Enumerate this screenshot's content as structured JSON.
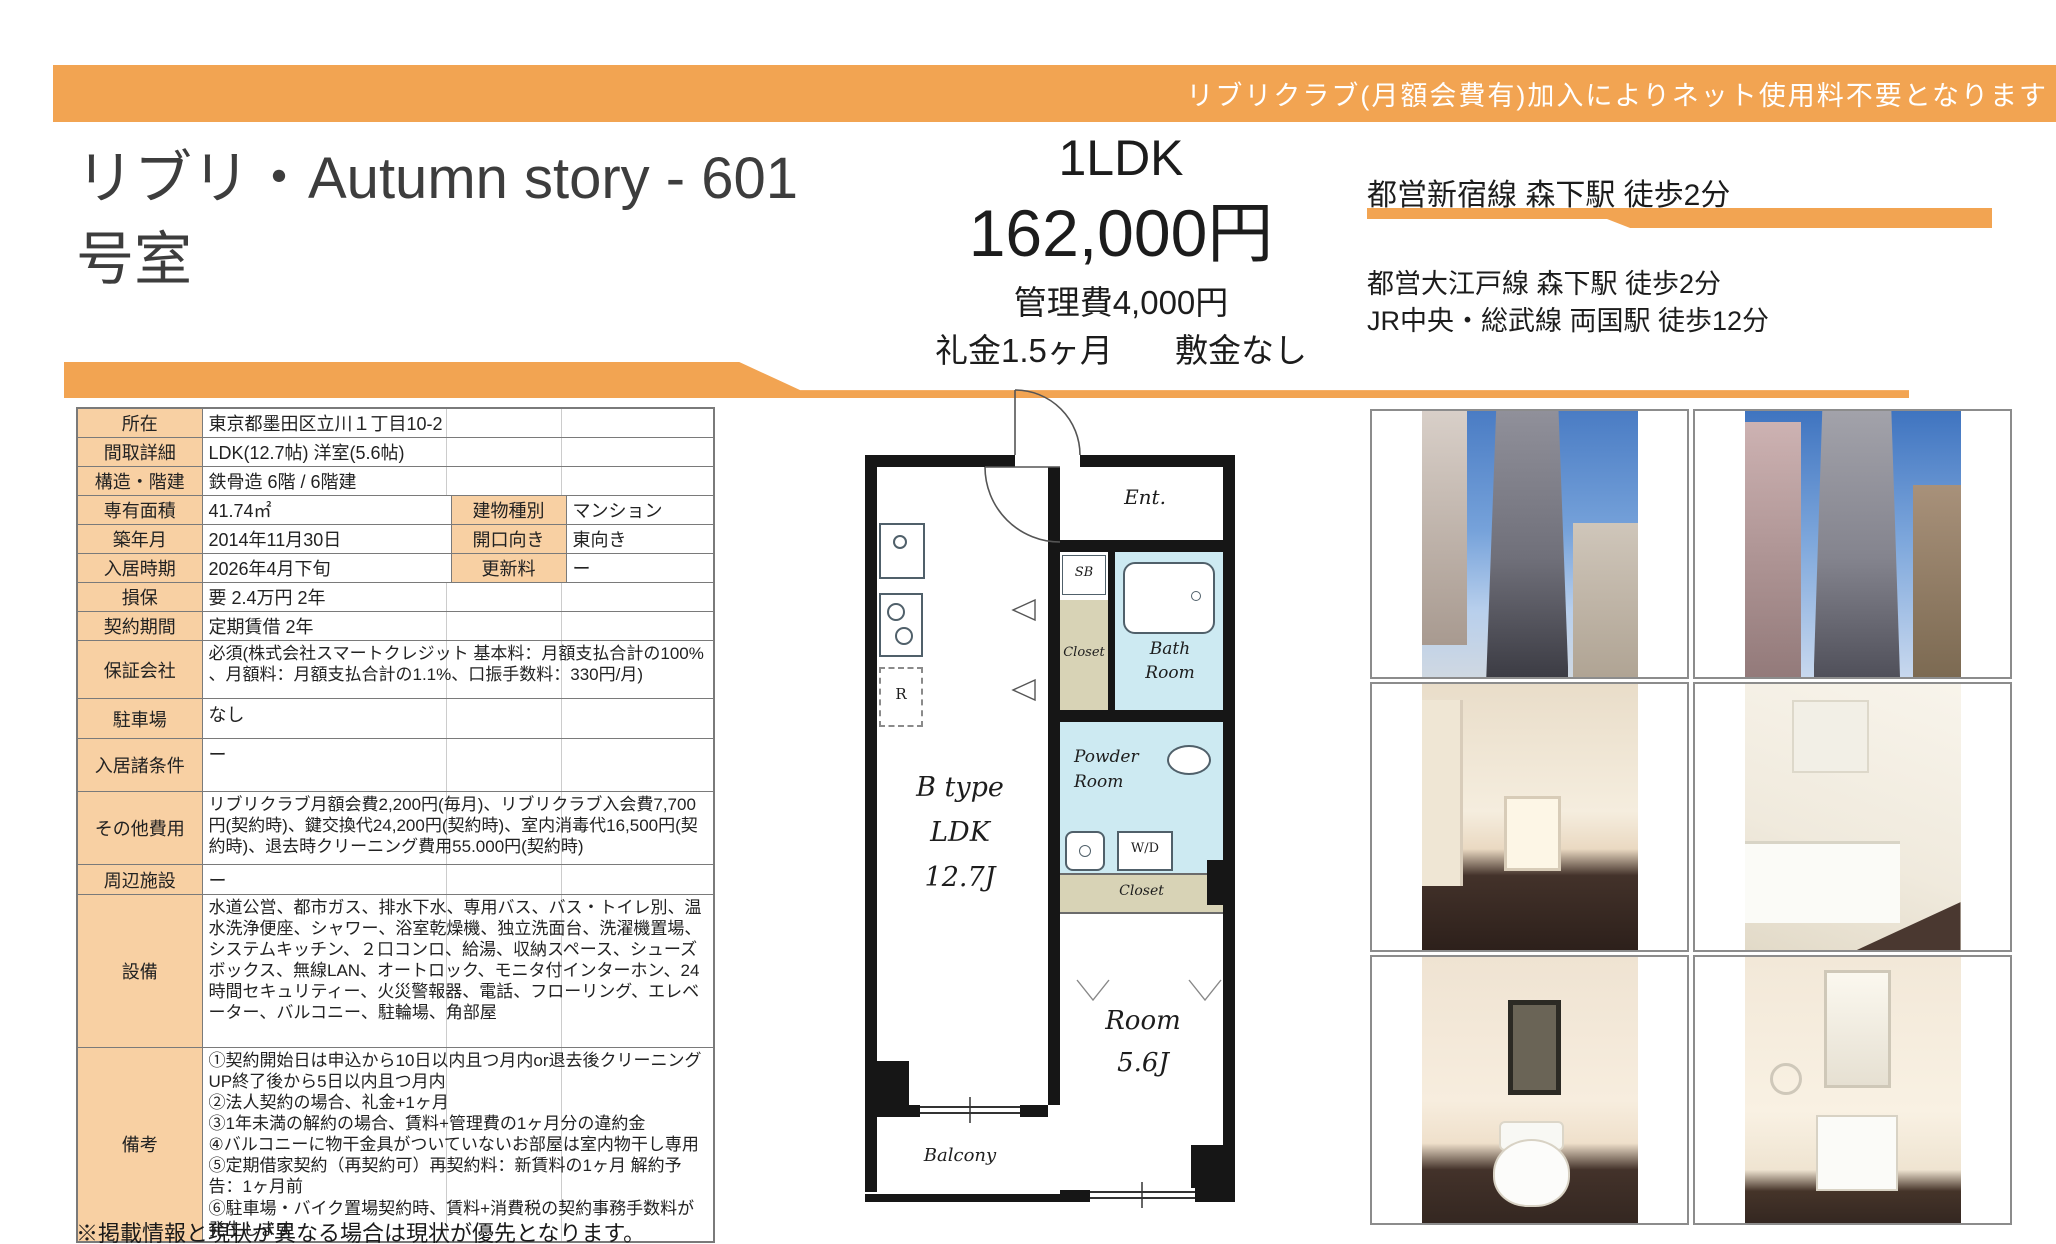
{
  "banner": {
    "text": "リブリクラブ(月額会費有)加入によりネット使用料不要となります"
  },
  "header": {
    "title_line1": "リブリ・Autumn story - 601",
    "title_line2": "号室"
  },
  "summary": {
    "layout": "1LDK",
    "rent": "162,000円",
    "management_fee": "管理費4,000円",
    "key_money": "礼金1.5ヶ月",
    "deposit": "敷金なし"
  },
  "access": {
    "line1": "都営新宿線 森下駅 徒歩2分",
    "line2": "都営大江戸線 森下駅 徒歩2分",
    "line3": "JR中央・総武線 両国駅 徒歩12分"
  },
  "table": {
    "rows": [
      {
        "label": "所在",
        "value": "東京都墨田区立川１丁目10-2"
      },
      {
        "label": "間取詳細",
        "value": "LDK(12.7帖) 洋室(5.6帖)"
      },
      {
        "label": "構造・階建",
        "value": "鉄骨造 6階 / 6階建"
      },
      {
        "label": "専有面積",
        "value": "41.74㎡",
        "label2": "建物種別",
        "value2": "マンション"
      },
      {
        "label": "築年月",
        "value": "2014年11月30日",
        "label2": "開口向き",
        "value2": "東向き"
      },
      {
        "label": "入居時期",
        "value": "2026年4月下旬",
        "label2": "更新料",
        "value2": "ー"
      },
      {
        "label": "損保",
        "value": "要 2.4万円 2年"
      },
      {
        "label": "契約期間",
        "value": "定期賃借 2年"
      },
      {
        "label": "保証会社",
        "value": "必須(株式会社スマートクレジット 基本料：月額支払合計の100% 、月額料：月額支払合計の1.1%、口振手数料：330円/月)"
      },
      {
        "label": "駐車場",
        "value": "なし"
      },
      {
        "label": "入居諸条件",
        "value": "ー"
      },
      {
        "label": "その他費用",
        "value": "リブリクラブ月額会費2,200円(毎月)、リブリクラブ入会費7,700円(契約時)、鍵交換代24,200円(契約時)、室内消毒代16,500円(契約時)、退去時クリーニング費用55.000円(契約時)"
      },
      {
        "label": "周辺施設",
        "value": "ー"
      },
      {
        "label": "設備",
        "value": "水道公営、都市ガス、排水下水、専用バス、バス・トイレ別、温水洗浄便座、シャワー、浴室乾燥機、独立洗面台、洗濯機置場、システムキッチン、２口コンロ、給湯、収納スペース、シューズボックス、無線LAN、オートロック、モニタ付インターホン、24時間セキュリティー、火災警報器、電話、フローリング、エレベーター、バルコニー、駐輪場、角部屋"
      },
      {
        "label": "備考",
        "value": "①契約開始日は申込から10日以内且つ月内or退去後クリーニングUP終了後から5日以内且つ月内\n②法人契約の場合、礼金+1ヶ月\n③1年未満の解約の場合、賃料+管理費の1ヶ月分の違約金\n④バルコニーに物干金具がついていないお部屋は室内物干し専用\n⑤定期借家契約（再契約可）再契約料：新賃料の1ヶ月 解約予告：1ヶ月前\n⑥駐車場・バイク置場契約時、賃料+消費税の契約事務手数料が発生します"
      }
    ]
  },
  "floorplan": {
    "ent": "Ent.",
    "sb": "SB",
    "closet_upper": "Closet",
    "bath_line1": "Bath",
    "bath_line2": "Room",
    "powder_line1": "Powder",
    "powder_line2": "Room",
    "wd": "W/D",
    "closet_mid": "Closet",
    "ldk_line1": "B type",
    "ldk_line2": "LDK",
    "ldk_line3": "12.7J",
    "room_line1": "Room",
    "room_line2": "5.6J",
    "balcony": "Balcony",
    "fridge": "R"
  },
  "photos": {
    "names": [
      "building-exterior-front",
      "building-exterior-side",
      "hallway-interior",
      "kitchen",
      "toilet-room",
      "washbasin-vanity"
    ]
  },
  "footer": {
    "note": "※掲載情報と現状が異なる場合は現状が優先となります。"
  },
  "colors": {
    "accent_orange": "#F2A452",
    "table_label_peach": "#F8D0A3",
    "wet_area_blue": "#CDEAF2",
    "closet_tan": "#D8D3B6"
  }
}
